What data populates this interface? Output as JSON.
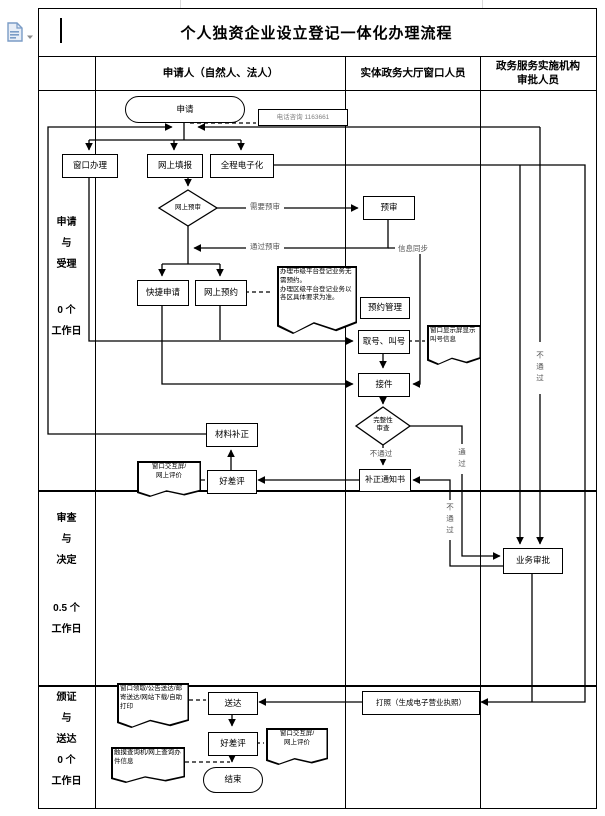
{
  "page": {
    "title": "个人独资企业设立登记一体化办理流程",
    "app_icon": "document-paste-icon"
  },
  "columns": {
    "applicant": "申请人（自然人、法人）",
    "window_staff": "实体政务大厅窗口人员",
    "approver": "政务服务实施机构\n审批人员"
  },
  "lanes": [
    {
      "phase": "申请\n与\n受理",
      "duration": "0 个\n工作日"
    },
    {
      "phase": "审查\n与\n决定",
      "duration": "0.5 个\n工作日"
    },
    {
      "phase": "颁证\n与\n送达",
      "duration": "0 个\n工作日"
    }
  ],
  "nodes": {
    "start": "申请",
    "phone_note": "电话咨询 1163661",
    "window_handle": "窗口办理",
    "online_fill": "网上填报",
    "full_electronic": "全程电子化",
    "online_pre_check": "网上预审",
    "pre_review": "预审",
    "quick_apply": "快捷申请",
    "online_booking": "网上预约",
    "booking_manage": "预约管理",
    "take_number": "取号、叫号",
    "receive": "接件",
    "completeness_check": "完整性\n审查",
    "correction_notice": "补正通知书",
    "material_correction": "材料补正",
    "rating_1": "好差评",
    "approval": "业务审批",
    "delivery": "送达",
    "print_license": "打照（生成电子营业执照）",
    "rating_2": "好差评",
    "end": "结束"
  },
  "edge_labels": {
    "need_pre_review": "需要预审",
    "pass_pre_review": "通过预审",
    "info_sync": "信息同步",
    "fail_1": "不通过",
    "pass": "通过",
    "fail_2": "不通过",
    "fail_right": "不通过"
  },
  "annotations": {
    "booking_note": "办理市级平台登记业务无需预约。\n办理区级平台登记业务以各区具体要求为准。",
    "call_display_note": "窗口显示屏显示叫号信息",
    "rating_note_1": "窗口交互屏/\n网上评价",
    "delivery_note": "窗口领取/公告送达/邮寄送达/网站下载/自助打印",
    "rating_note_2": "窗口交互屏/\n网上评价",
    "query_note": "触摸查询机/网上查询办件信息"
  },
  "colors": {
    "line": "#000000",
    "label_muted": "#555555",
    "phone_text": "#808080"
  }
}
